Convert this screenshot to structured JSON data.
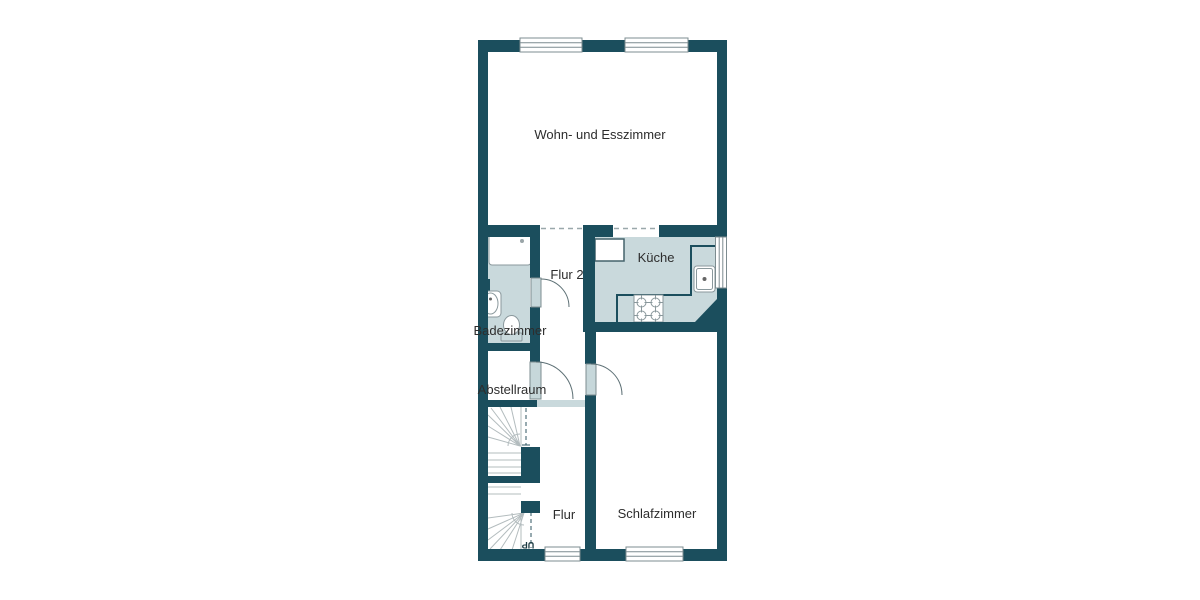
{
  "plan": {
    "type": "floor-plan",
    "palette": {
      "wall_color": "#1b4e5d",
      "room_fill_color": "#c9d9dc",
      "floor_color": "#ffffff",
      "fixture_outline_color": "#8a989c",
      "label_color": "#2d2d2d"
    },
    "rooms": {
      "living": {
        "label": "Wohn- und Esszimmer"
      },
      "kitchen": {
        "label": "Küche"
      },
      "hall2": {
        "label": "Flur 2"
      },
      "bathroom": {
        "label": "Badezimmer"
      },
      "storage": {
        "label": "Abstellraum"
      },
      "hall": {
        "label": "Flur"
      },
      "bedroom": {
        "label": "Schlafzimmer"
      }
    },
    "stairs": {
      "upper_label": "UP",
      "lower_label": "UP"
    },
    "fixtures": [
      "shower",
      "washbasin",
      "toilet",
      "radiator",
      "stove-4-burners",
      "kitchen-sink",
      "kitchen-counter",
      "fridge-counter"
    ],
    "features": [
      "window-living-left",
      "window-living-right",
      "window-kitchen-right",
      "window-hall-bottom",
      "window-bedroom-bottom",
      "door-bathroom",
      "door-storage",
      "door-bedroom",
      "opening-hall2-living",
      "opening-kitchen-living",
      "stairs-up-upper-flight",
      "stairs-up-lower-flight"
    ]
  }
}
